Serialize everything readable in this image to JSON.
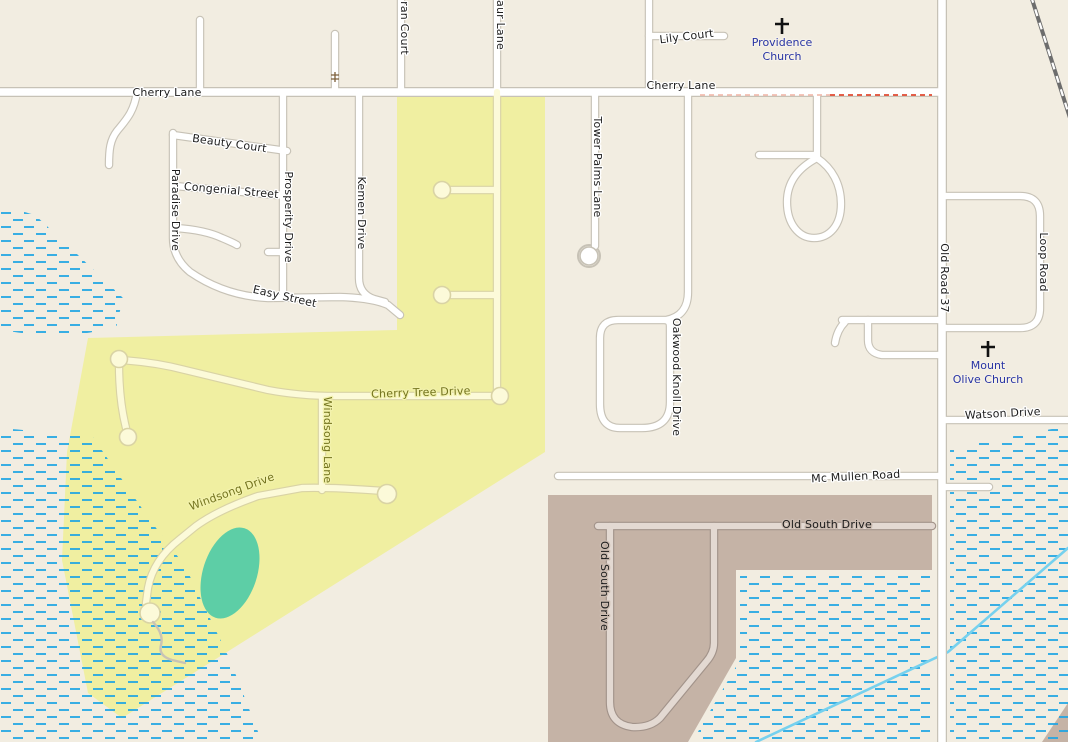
{
  "colors": {
    "bg": "#f2ede1",
    "yellow_area": "#f0efa1",
    "brown_area": "#c5b3a6",
    "pond_green": "#5dcea6",
    "wetland_blue": "#1ea5e3",
    "stream_blue": "#76d1ee",
    "railway_gray": "#6d6d6d",
    "barrier_red": "#e14a30",
    "church_label": "#2834a4",
    "street_label": "#1c1c1c",
    "yellow_label": "#73731e"
  },
  "streets": {
    "cherry_lane": "Cherry Lane",
    "lily_court": "Lily Court",
    "ran_court": "ran Court",
    "aur_lane": "aur Lane",
    "beauty_court": "Beauty Court",
    "congenial_street": "Congenial Street",
    "paradise_drive": "Paradise Drive",
    "prosperity_drive": "Prosperity Drive",
    "kemen_drive": "Kemen Drive",
    "easy_street": "Easy Street",
    "tower_palms_lane": "Tower Palms Lane",
    "oakwood_knoll_drive": "Oakwood Knoll Drive",
    "old_road_37": "Old Road 37",
    "loop_road": "Loop Road",
    "watson_drive": "Watson Drive",
    "mc_mullen_road": "Mc Mullen Road",
    "old_south_drive": "Old South Drive",
    "cherry_tree_drive": "Cherry Tree Drive",
    "windsong_lane": "Windsong Lane",
    "windsong_drive": "Windsong Drive"
  },
  "pois": {
    "providence_church_l1": "Providence",
    "providence_church_l2": "Church",
    "mount_olive_church_l1": "Mount",
    "mount_olive_church_l2": "Olive Church"
  }
}
